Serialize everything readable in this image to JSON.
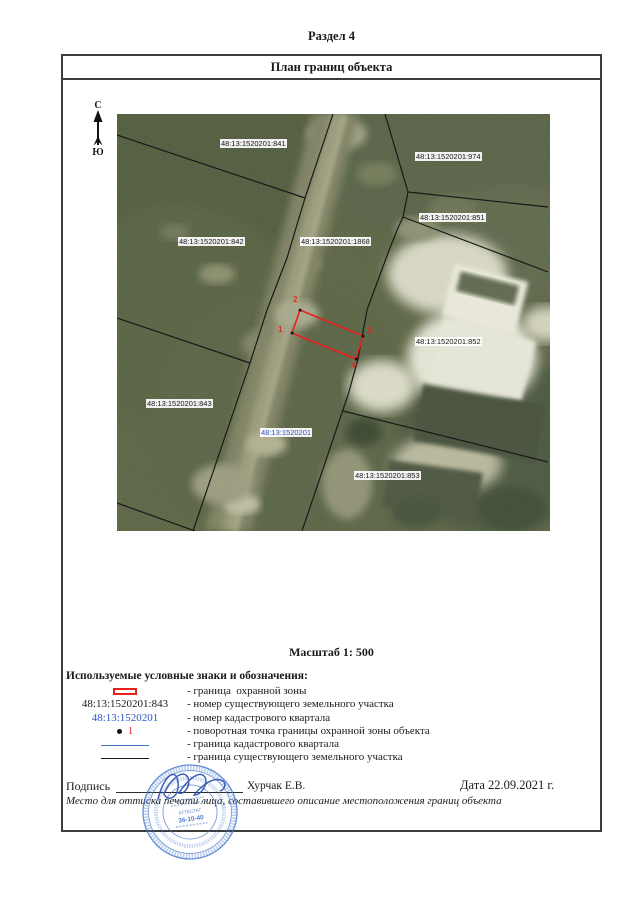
{
  "page": {
    "section_title": "Раздел 4"
  },
  "plan": {
    "title": "План границ объекта",
    "scale": "Масштаб 1: 500"
  },
  "compass": {
    "north": "С",
    "south": "Ю"
  },
  "map": {
    "labels": [
      {
        "text": "48:13:1520201:841",
        "type": "parcel"
      },
      {
        "text": "48:13:1520201:974",
        "type": "parcel"
      },
      {
        "text": "48:13:1520201:851",
        "type": "parcel"
      },
      {
        "text": "48:13:1520201:842",
        "type": "parcel"
      },
      {
        "text": "48:13:1520201:1868",
        "type": "parcel"
      },
      {
        "text": "48:13:1520201:852",
        "type": "parcel"
      },
      {
        "text": "48:13:1520201:843",
        "type": "parcel"
      },
      {
        "text": "48:13:1520201",
        "type": "quarter"
      },
      {
        "text": "48:13:1520201:853",
        "type": "parcel"
      }
    ],
    "vertices": [
      "1",
      "2",
      "3",
      "4"
    ]
  },
  "legend": {
    "heading": "Используемые условные знаки и обозначения:",
    "items": [
      {
        "symbol": "red-rect",
        "desc": "- граница  охранной зоны"
      },
      {
        "symbol": "parcel-number",
        "symbol_text": "48:13:1520201:843",
        "desc": "- номер существующего земельного участка"
      },
      {
        "symbol": "quarter-number",
        "symbol_text": "48:13:1520201",
        "desc": "- номер кадастрового квартала"
      },
      {
        "symbol": "turn-point",
        "point_number": "1",
        "desc": "- поворотная точка границы охранной зоны объекта"
      },
      {
        "symbol": "blue-line",
        "desc": "- граница кадастрового квартала"
      },
      {
        "symbol": "black-line",
        "desc": "- граница существующего земельного участка"
      }
    ]
  },
  "footer": {
    "signature_label": "Подпись",
    "signer": "Хурчак Е.В.",
    "date": "Дата 22.09.2021 г.",
    "note": "Место для оттиска печати лица, составившего описание местоположения границ объекта"
  },
  "stamp": {
    "line1": "АТТЕСТАТ",
    "line2": "36-10-40"
  },
  "colors": {
    "protection_zone_red": "#e8201e",
    "quarter_blue": "#2f55c4",
    "quarter_line_blue": "#4a72c8",
    "boundary_black": "#1a1a1a",
    "stamp_blue": "#3f74c9"
  }
}
